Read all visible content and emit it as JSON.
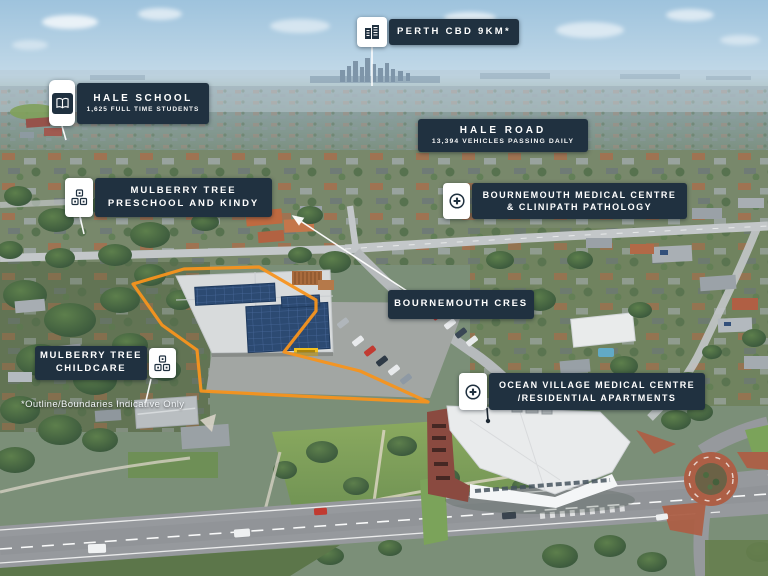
{
  "annotations": {
    "perth_cbd": {
      "icon": "city-buildings-icon",
      "lines": [
        "PERTH CBD 9KM*"
      ]
    },
    "hale_school": {
      "icon": "open-book-icon",
      "lines": [
        "HALE SCHOOL",
        "1,625 FULL TIME STUDENTS"
      ]
    },
    "hale_road": {
      "lines": [
        "HALE ROAD",
        "13,394 VEHICLES PASSING DAILY"
      ]
    },
    "mulberry_preschool": {
      "icon": "toy-blocks-icon",
      "lines": [
        "MULBERRY TREE",
        "PRESCHOOL AND KINDY"
      ]
    },
    "bournemouth_medical": {
      "icon": "medical-cross-icon",
      "lines": [
        "BOURNEMOUTH MEDICAL CENTRE",
        "& CLINIPATH PATHOLOGY"
      ]
    },
    "bournemouth_cres": {
      "lines": [
        "BOURNEMOUTH CRES"
      ]
    },
    "mulberry_childcare": {
      "icon": "toy-blocks-icon",
      "lines": [
        "MULBERRY TREE",
        "CHILDCARE"
      ]
    },
    "ocean_village": {
      "icon": "medical-cross-icon",
      "lines": [
        "OCEAN VILLAGE MEDICAL CENTRE",
        "/RESIDENTIAL APARTMENTS"
      ]
    }
  },
  "disclaimer": "*Outline/Boundaries Indicative Only",
  "colors": {
    "label_navy": "#203140",
    "label_text": "#FFFFFF",
    "outline_orange": "#F7941D"
  }
}
